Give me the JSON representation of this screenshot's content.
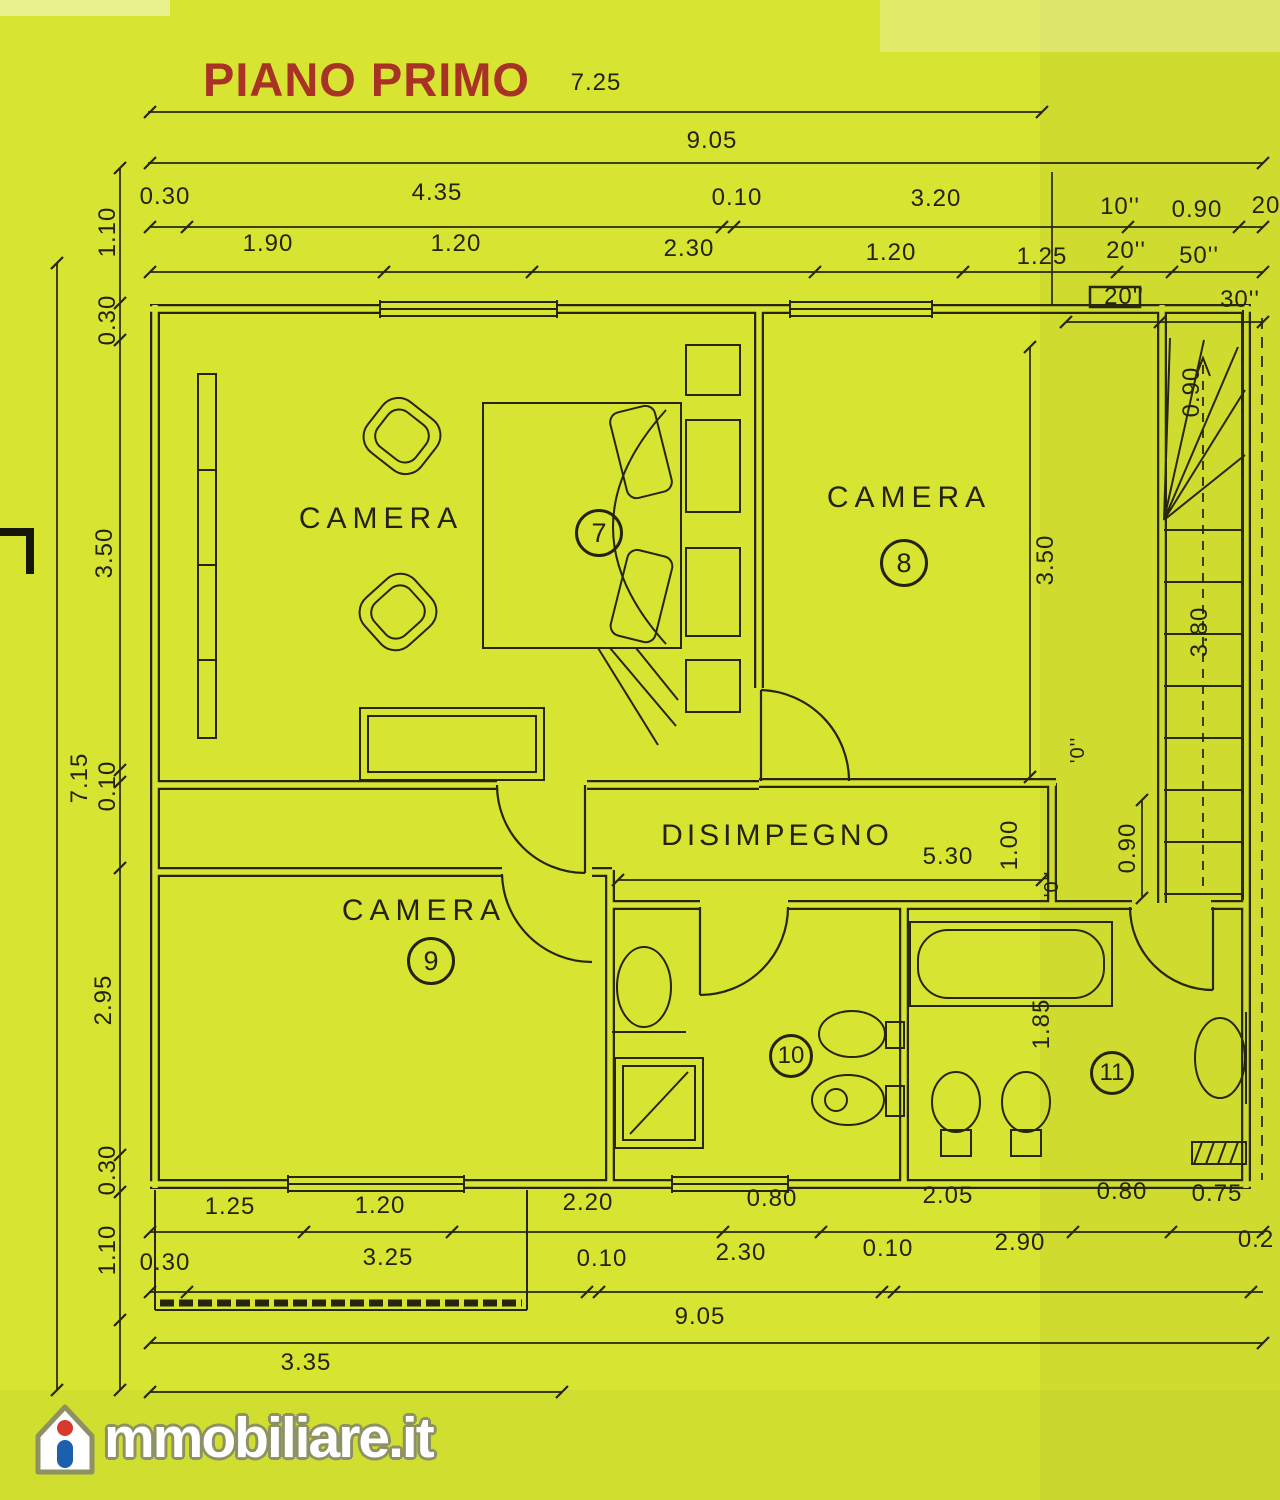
{
  "title": "PIANO PRIMO",
  "rooms": {
    "camera7": {
      "label": "CAMERA",
      "number": "7"
    },
    "camera8": {
      "label": "CAMERA",
      "number": "8"
    },
    "camera9": {
      "label": "CAMERA",
      "number": "9"
    },
    "bath10": {
      "number": "10"
    },
    "bath11": {
      "number": "11"
    },
    "disimpegno": {
      "label": "DISIMPEGNO"
    }
  },
  "dims": {
    "top_width_a": "7.25",
    "top_width_b": "9.05",
    "top_row1": [
      "0.30",
      "4.35",
      "0.10",
      "3.20",
      "10''",
      "0.90",
      "20"
    ],
    "top_row2": [
      "1.90",
      "1.20",
      "2.30",
      "1.20",
      "1.25",
      "20''",
      "50''"
    ],
    "top_row3": [
      "20''",
      "30''"
    ],
    "left_col": [
      "1.10",
      "0.30",
      "3.50",
      "0.10",
      "2.95",
      "0.30",
      "1.10"
    ],
    "left_total": "7.15",
    "camera8_height": "3.50",
    "stairs_width": "0.90",
    "stairs_run": "3.80",
    "corridor_length": "5.30",
    "corridor_width_a": "1.00",
    "corridor_width_b": "0.90",
    "level_mark_a": "'0''",
    "level_mark_b": "'0''",
    "bath11_depth": "1.85",
    "bottom_row1": [
      "1.25",
      "1.20",
      "2.20",
      "0.80",
      "2.05",
      "0.80",
      "0.75"
    ],
    "bottom_row2": [
      "0.30",
      "3.25",
      "0.10",
      "2.30",
      "0.10",
      "2.90",
      "0.2"
    ],
    "bottom_width": "9.05",
    "terrace_width": "3.35"
  },
  "logo": {
    "main": "mmobiliare",
    "tld": ".it"
  },
  "colors": {
    "background": "#d7e432",
    "line": "#26260f",
    "title": "#a93226",
    "logo_blue": "#1c5fae",
    "logo_red": "#d8392c",
    "logo_white": "#ffffff"
  }
}
